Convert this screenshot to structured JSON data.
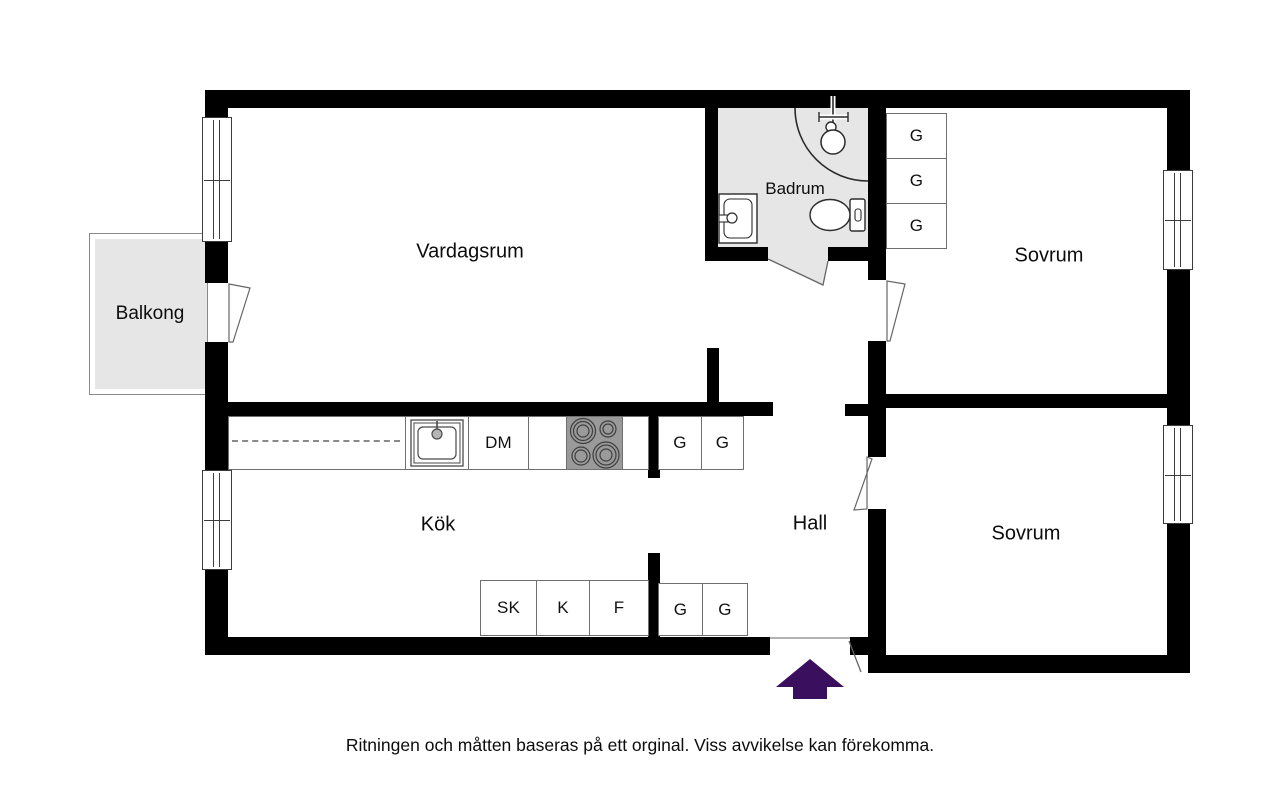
{
  "floorplan": {
    "rooms": {
      "vardagsrum": "Vardagsrum",
      "badrum": "Badrum",
      "sovrum_top": "Sovrum",
      "sovrum_bottom": "Sovrum",
      "kok": "Kök",
      "hall": "Hall",
      "balkong": "Balkong"
    },
    "cabinets": {
      "bedroom_wardrobes": [
        "G",
        "G",
        "G"
      ],
      "hall_upper": [
        "G",
        "G"
      ],
      "hall_lower": [
        "G",
        "G"
      ],
      "kitchen_dishwasher": "DM",
      "kitchen_lower": [
        "SK",
        "K",
        "F"
      ]
    },
    "icons": {
      "stove": "stove-burners-icon",
      "kitchen_sink": "kitchen-sink-icon",
      "bathroom_sink": "bathroom-sink-icon",
      "toilet": "toilet-icon",
      "shower": "corner-shower-icon",
      "entrance_arrow": "entrance-arrow-icon"
    },
    "colors": {
      "wall": "#000000",
      "wet_room_floor": "#e6e6e6",
      "stove": "#9a9a9a",
      "entrance_arrow": "#3a0f5e"
    },
    "footer": "Ritningen och måtten baseras på ett orginal. Viss avvikelse kan förekomma."
  }
}
